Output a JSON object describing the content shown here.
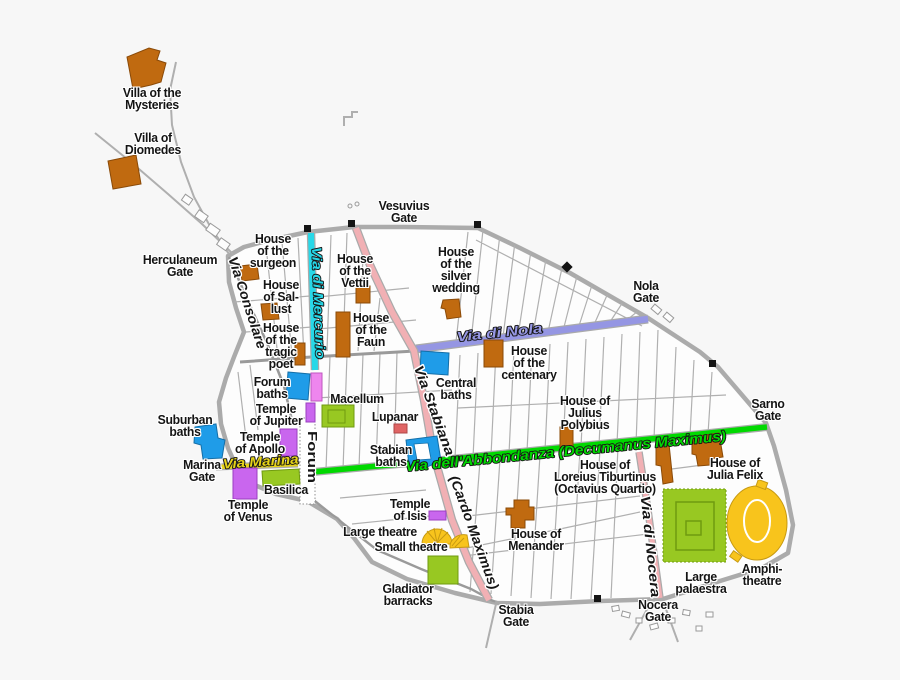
{
  "colors": {
    "bg": "#f7f7f7",
    "wall": "#ababab",
    "street-thin": "#b0b0b0",
    "street-main": "#9a9a9a",
    "house": "#c06a10",
    "bath": "#1f9ce8",
    "temple": "#c966ee",
    "public": "#98c822",
    "theatre": "#f8c41c",
    "lupanar": "#e06565",
    "pink-building": "#ee86ee",
    "street-mercurio": "#27d8e8",
    "street-stabiana": "#f1b0b4",
    "street-nola": "#9596e3",
    "street-abbondanza": "#00d900",
    "street-marina": "#e6d318",
    "street-nocera": "#f1b0b4"
  },
  "labels": {
    "villa_mysteries": "Villa of the\nMysteries",
    "villa_diomedes": "Villa of\nDiomedes",
    "herculaneum_gate": "Herculaneum\nGate",
    "vesuvius_gate": "Vesuvius\nGate",
    "nola_gate": "Nola\nGate",
    "sarno_gate": "Sarno\nGate",
    "nocera_gate": "Nocera\nGate",
    "stabia_gate": "Stabia\nGate",
    "marina_gate": "Marina\nGate",
    "house_surgeon": "House\nof the\nsurgeon",
    "house_sallust": "House\nof Sal-\nlust",
    "house_tragic_poet": "House\nof the\ntragic\npoet",
    "house_vettii": "House\nof the\nVettii",
    "house_faun": "House\nof the\nFaun",
    "house_silver_wedding": "House\nof the\nsilver\nwedding",
    "house_centenary": "House\nof the\ncentenary",
    "central_baths": "Central\nbaths",
    "forum_baths": "Forum\nbaths",
    "macellum": "Macellum",
    "lupanar": "Lupanar",
    "temple_jupiter": "Temple\nof Jupiter",
    "temple_apollo": "Temple\nof Apollo",
    "suburban_baths": "Suburban\nbaths",
    "basilica": "Basilica",
    "temple_venus": "Temple\nof Venus",
    "stabian_baths": "Stabian\nbaths",
    "temple_isis": "Temple\nof Isis",
    "large_theatre": "Large theatre",
    "small_theatre": "Small theatre",
    "gladiator_barracks": "Gladiator\nbarracks",
    "house_menander": "House of\nMenander",
    "house_julius_polybius": "House of\nJulius\nPolybius",
    "house_loreius": "House of\nLoreius Tiburtinus\n(Octavius Quartio)",
    "house_julia_felix": "House of\nJulia Felix",
    "large_palaestra": "Large\npalaestra",
    "amphitheatre": "Amphi-\ntheatre"
  },
  "streets": {
    "consolare": "Via Consolare",
    "mercurio": "Via di Mercurio",
    "stabiana": "Via Stabiana",
    "cardo": "(Cardo Maximus)",
    "nola": "Via di Nola",
    "abbondanza": "Via dell'Abbondanza (Decumanus Maximus)",
    "marina": "Via Marina",
    "nocera": "Via di Nocera",
    "forum_area": "Forum"
  }
}
